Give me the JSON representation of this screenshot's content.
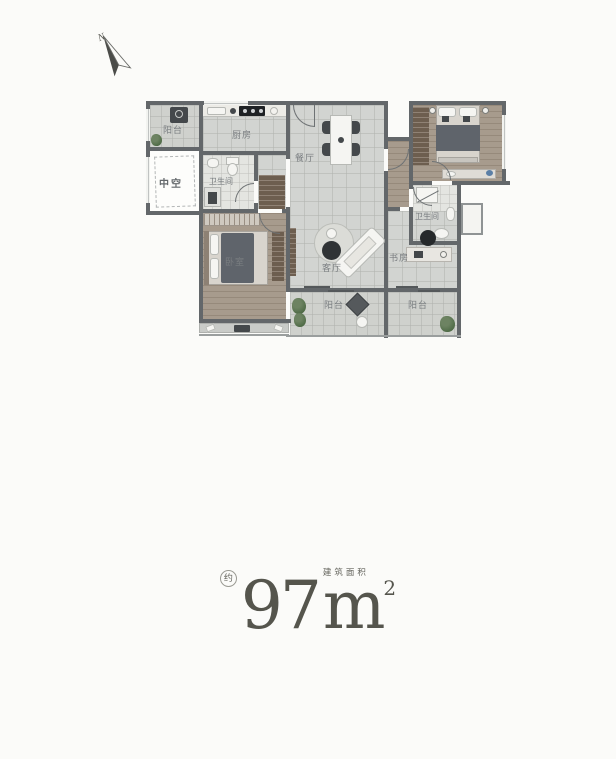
{
  "compass": {
    "label": "N"
  },
  "plan": {
    "rooms": {
      "balcony_top_left": {
        "label": "阳台"
      },
      "kitchen": {
        "label": "厨房"
      },
      "void_space": {
        "label": "中空"
      },
      "bathroom_1": {
        "label": "卫生间"
      },
      "bedroom_left": {
        "label": "卧室"
      },
      "dining": {
        "label": "餐厅"
      },
      "living": {
        "label": "客厅"
      },
      "balcony_bottom_left": {
        "label": "阳台"
      },
      "bathroom_2": {
        "label": "卫生间"
      },
      "study": {
        "label": "书房"
      },
      "balcony_bottom_right": {
        "label": "阳台"
      }
    }
  },
  "area": {
    "approx": "约",
    "value": "97",
    "unit": "m",
    "exponent": "2",
    "caption": "建筑面积"
  },
  "colors": {
    "wall": "#63676a",
    "tile_floor": "#d2d4d1",
    "wood_floor": "#a79b8d",
    "accent_text": "#55554d"
  }
}
